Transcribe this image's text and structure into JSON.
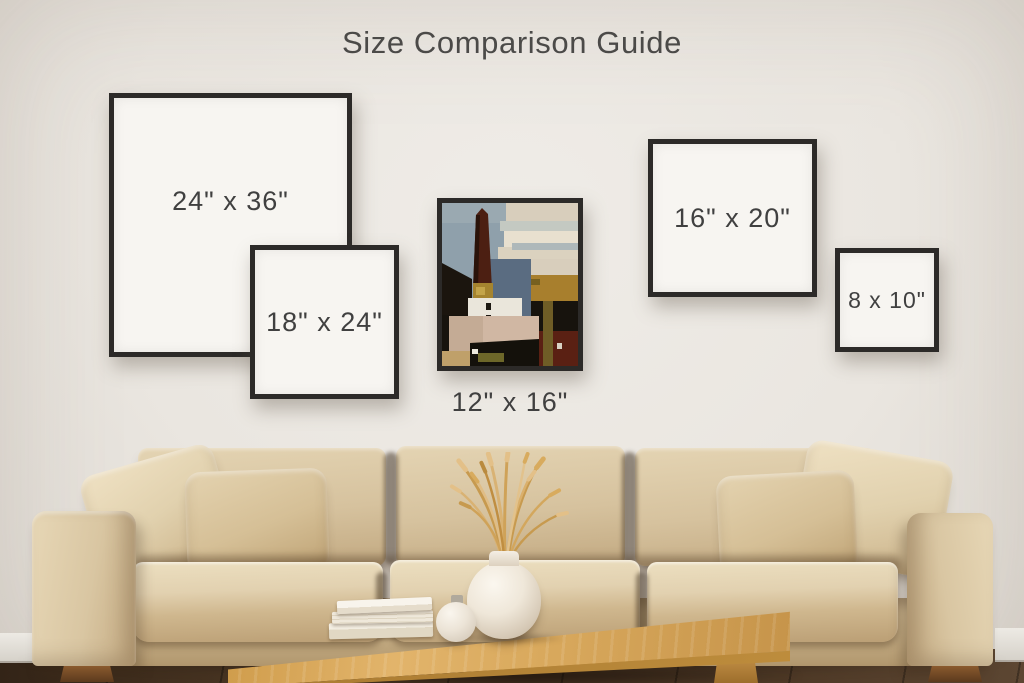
{
  "title": "Size Comparison Guide",
  "frames": {
    "f24x36": {
      "label": "24\" x 36\""
    },
    "f18x24": {
      "label": "18\" x 24\""
    },
    "f12x16": {
      "label": "12\" x 16\""
    },
    "f16x20": {
      "label": "16\" x 20\""
    },
    "f8x10": {
      "label": "8 x 10\""
    }
  },
  "artwork": {
    "alt": "abstract painting of a church tower landscape"
  },
  "colors": {
    "wall": "#eae6e0",
    "frame_border": "#2c2a28",
    "frame_mat": "#f7f5f1",
    "title_text": "#4b4a48",
    "label_text": "#404040",
    "sofa_beige": "#d6c3a1",
    "table_wood": "#d7a756",
    "floor_wood": "#43301f"
  },
  "scene": {
    "sofa": "beige fabric three-seat sofa with four pillows",
    "table": "light oak coffee table",
    "table_items": [
      "stack of books",
      "small round vase",
      "round vase with dried wheat stems"
    ]
  }
}
